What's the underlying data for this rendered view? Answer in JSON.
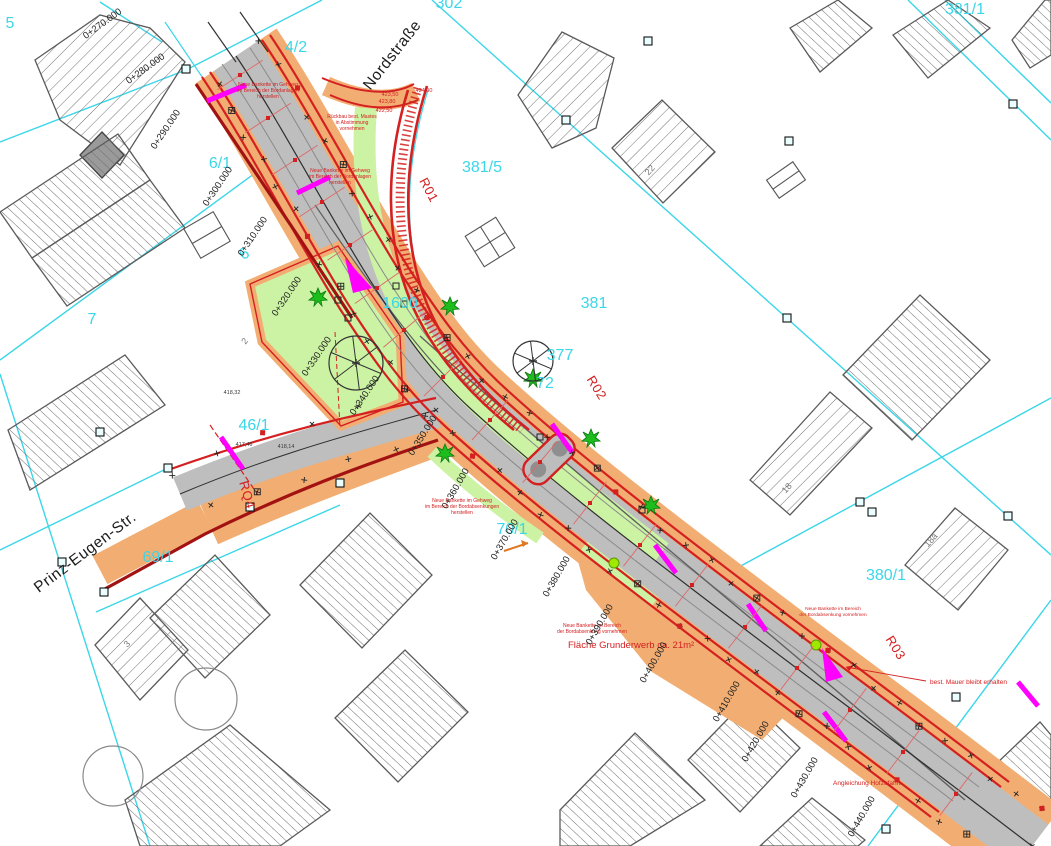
{
  "drawing_type": "road-construction-site-plan",
  "colors": {
    "parcel_cyan": "#3BD6E8",
    "plan_red": "#D42020",
    "dark_red": "#A31212",
    "road_gray": "#BEBEBE",
    "shoulder_orange": "#F2AE72",
    "verge_green": "#CBF3A3",
    "section_magenta": "#FF00FF",
    "tree_green": "#1DBD1D",
    "dot_lime": "#9FE800"
  },
  "street_names": [
    {
      "t": "Nordstraße",
      "x": 396,
      "y": 58,
      "r": -52
    },
    {
      "t": "Prinz-Eugen-Str.",
      "x": 88,
      "y": 556,
      "r": -37
    }
  ],
  "parcel_labels": [
    {
      "t": "5",
      "x": 10,
      "y": 28
    },
    {
      "t": "4/2",
      "x": 296,
      "y": 52
    },
    {
      "t": "302",
      "x": 449,
      "y": 8
    },
    {
      "t": "381/1",
      "x": 965,
      "y": 14
    },
    {
      "t": "381/5",
      "x": 482,
      "y": 172
    },
    {
      "t": "6/1",
      "x": 220,
      "y": 168
    },
    {
      "t": "6",
      "x": 247,
      "y": 258,
      "r": -35
    },
    {
      "t": "7",
      "x": 92,
      "y": 324
    },
    {
      "t": "1600",
      "x": 400,
      "y": 308
    },
    {
      "t": "381",
      "x": 594,
      "y": 308
    },
    {
      "t": "377",
      "x": 560,
      "y": 360
    },
    {
      "t": "72",
      "x": 545,
      "y": 388
    },
    {
      "t": "46/1",
      "x": 254,
      "y": 430
    },
    {
      "t": "69/1",
      "x": 158,
      "y": 562
    },
    {
      "t": "70/1",
      "x": 512,
      "y": 534
    },
    {
      "t": "380/1",
      "x": 886,
      "y": 580
    }
  ],
  "building_numbers": [
    {
      "t": "2",
      "x": 247,
      "y": 343,
      "r": -50
    },
    {
      "t": "3",
      "x": 129,
      "y": 646,
      "r": -45
    },
    {
      "t": "22",
      "x": 652,
      "y": 172,
      "r": -48
    },
    {
      "t": "18",
      "x": 789,
      "y": 490,
      "r": -48
    },
    {
      "t": "18a",
      "x": 933,
      "y": 542,
      "r": -48
    }
  ],
  "section_labels": [
    {
      "t": "R01",
      "x": 425,
      "y": 192,
      "r": 62
    },
    {
      "t": "R02",
      "x": 593,
      "y": 390,
      "r": 58
    },
    {
      "t": "R03",
      "x": 892,
      "y": 650,
      "r": 58
    },
    {
      "t": "RQ4",
      "x": 243,
      "y": 496,
      "r": 74
    }
  ],
  "stations": [
    {
      "label": "0+270.000",
      "lx": 104,
      "ly": 26,
      "lr": -36,
      "tx": 240,
      "ty": 75,
      "ta": 57
    },
    {
      "label": "0+280.000",
      "lx": 147,
      "ly": 71,
      "lr": -36,
      "tx": 268,
      "ty": 118,
      "ta": 57
    },
    {
      "label": "0+290.000",
      "lx": 168,
      "ly": 131,
      "lr": -56,
      "tx": 295,
      "ty": 160,
      "ta": 57
    },
    {
      "label": "0+300.000",
      "lx": 220,
      "ly": 188,
      "lr": -56,
      "tx": 322,
      "ty": 202,
      "ta": 57
    },
    {
      "label": "0+310.000",
      "lx": 255,
      "ly": 238,
      "lr": -56,
      "tx": 350,
      "ty": 245,
      "ta": 56
    },
    {
      "label": "0+320.000",
      "lx": 289,
      "ly": 298,
      "lr": -56,
      "tx": 377,
      "ty": 288,
      "ta": 55
    },
    {
      "label": "0+330.000",
      "lx": 319,
      "ly": 358,
      "lr": -56,
      "tx": 404,
      "ty": 330,
      "ta": 50
    },
    {
      "label": "0+340.000",
      "lx": 367,
      "ly": 397,
      "lr": -56,
      "tx": 443,
      "ty": 377,
      "ta": 45
    },
    {
      "label": "0+350.000",
      "lx": 425,
      "ly": 437,
      "lr": -58,
      "tx": 490,
      "ty": 420,
      "ta": 42
    },
    {
      "label": "0+360.000",
      "lx": 458,
      "ly": 490,
      "lr": -60,
      "tx": 540,
      "ty": 462,
      "ta": 40
    },
    {
      "label": "0+370.000",
      "lx": 507,
      "ly": 541,
      "lr": -60,
      "tx": 590,
      "ty": 503,
      "ta": 38
    },
    {
      "label": "0+380.000",
      "lx": 559,
      "ly": 578,
      "lr": -60,
      "tx": 640,
      "ty": 545,
      "ta": 38
    },
    {
      "label": "0+390.000",
      "lx": 602,
      "ly": 626,
      "lr": -60,
      "tx": 692,
      "ty": 585,
      "ta": 38
    },
    {
      "label": "0+400.000",
      "lx": 656,
      "ly": 664,
      "lr": -60,
      "tx": 745,
      "ty": 627,
      "ta": 38
    },
    {
      "label": "0+410.000",
      "lx": 729,
      "ly": 703,
      "lr": -60,
      "tx": 797,
      "ty": 668,
      "ta": 37
    },
    {
      "label": "0+420.000",
      "lx": 758,
      "ly": 743,
      "lr": -60,
      "tx": 850,
      "ty": 710,
      "ta": 37
    },
    {
      "label": "0+430.000",
      "lx": 807,
      "ly": 779,
      "lr": -60,
      "tx": 903,
      "ty": 752,
      "ta": 37
    },
    {
      "label": "0+440.000",
      "lx": 864,
      "ly": 818,
      "lr": -60,
      "tx": 956,
      "ty": 794,
      "ta": 37
    }
  ],
  "red_notes": [
    {
      "lines": [
        "Neue Bankette im Gehweg",
        "im Bereich der Bordanlagen",
        "herstellen"
      ],
      "x": 268,
      "y": 86,
      "s": 5
    },
    {
      "lines": [
        "Rückbau best. Mastes",
        "in Abstimmung",
        "vornehmen"
      ],
      "x": 352,
      "y": 118,
      "s": 5
    },
    {
      "lines": [
        "Neue Bankette im Gehweg",
        "im Bereich der Bordanlagen",
        "herstellen"
      ],
      "x": 340,
      "y": 172,
      "s": 5
    },
    {
      "lines": [
        "Neue Bankette im Gehweg",
        "im Bereich der Bordabsenkungen",
        "herstellen"
      ],
      "x": 462,
      "y": 502,
      "s": 5
    },
    {
      "lines": [
        "Neue Bankette im Bereich",
        "der Bordabsenkung vornehmen"
      ],
      "x": 592,
      "y": 627,
      "s": 5
    },
    {
      "lines": [
        "Neue Bankette im Bereich",
        "der Bordabsenkung vornehmen"
      ],
      "x": 833,
      "y": 610,
      "s": 4.8
    },
    {
      "t": "Fläche Grunderwerb ca. 21m²",
      "x": 568,
      "y": 648,
      "s": 9.5,
      "a": "start"
    },
    {
      "t": "best. Mauer bleibt erhalten",
      "x": 930,
      "y": 684,
      "s": 6.5,
      "a": "start"
    },
    {
      "t": "Angleichung Hofzufahrt",
      "x": 833,
      "y": 785,
      "s": 6.5,
      "a": "start"
    }
  ],
  "spot_elevations_red": [
    {
      "t": "423,50",
      "x": 390,
      "y": 96
    },
    {
      "t": "423,80",
      "x": 387,
      "y": 103
    },
    {
      "t": "424,00",
      "x": 424,
      "y": 92
    },
    {
      "t": "422,50",
      "x": 384,
      "y": 112
    }
  ],
  "spot_elevations_black": [
    {
      "t": "418,32",
      "x": 232,
      "y": 394
    },
    {
      "t": "417,46",
      "x": 244,
      "y": 446
    },
    {
      "t": "418,14",
      "x": 286,
      "y": 448
    }
  ],
  "symbols": {
    "trees": [
      [
        318,
        297
      ],
      [
        450,
        306
      ],
      [
        533,
        378
      ],
      [
        445,
        453
      ],
      [
        591,
        438
      ],
      [
        651,
        505
      ]
    ],
    "tree_rings": [
      {
        "x": 356,
        "y": 363,
        "r": 27
      },
      {
        "x": 533,
        "y": 361,
        "r": 20
      }
    ],
    "canopy_circles": [
      {
        "x": 206,
        "y": 699,
        "r": 31
      },
      {
        "x": 113,
        "y": 776,
        "r": 30
      }
    ],
    "green_dots": [
      [
        614,
        563
      ],
      [
        816,
        645
      ]
    ],
    "magenta_bars": [
      [
        207,
        101,
        246,
        85
      ],
      [
        297,
        193,
        330,
        177
      ],
      [
        221,
        437,
        243,
        469
      ],
      [
        552,
        424,
        572,
        452
      ],
      [
        655,
        545,
        676,
        573
      ],
      [
        748,
        604,
        766,
        631
      ],
      [
        824,
        712,
        846,
        741
      ],
      [
        1018,
        682,
        1038,
        706
      ]
    ],
    "magenta_wedges": [
      [
        [
          345,
          258
        ],
        [
          372,
          288
        ],
        [
          353,
          293
        ]
      ],
      [
        [
          822,
          648
        ],
        [
          843,
          677
        ],
        [
          826,
          682
        ]
      ]
    ],
    "cyan_square_markers": [
      [
        186,
        69
      ],
      [
        566,
        120
      ],
      [
        787,
        318
      ],
      [
        1008,
        516
      ],
      [
        1013,
        104
      ],
      [
        168,
        468
      ],
      [
        104,
        592
      ],
      [
        860,
        502
      ],
      [
        872,
        512
      ],
      [
        956,
        697
      ],
      [
        886,
        829
      ],
      [
        62,
        562
      ],
      [
        100,
        432
      ],
      [
        250,
        507
      ],
      [
        340,
        483
      ],
      [
        648,
        41
      ],
      [
        789,
        141
      ]
    ],
    "black_square_markers": [
      [
        338,
        300
      ],
      [
        348,
        318
      ],
      [
        396,
        286
      ],
      [
        404,
        304
      ],
      [
        540,
        437
      ],
      [
        642,
        510
      ]
    ]
  }
}
